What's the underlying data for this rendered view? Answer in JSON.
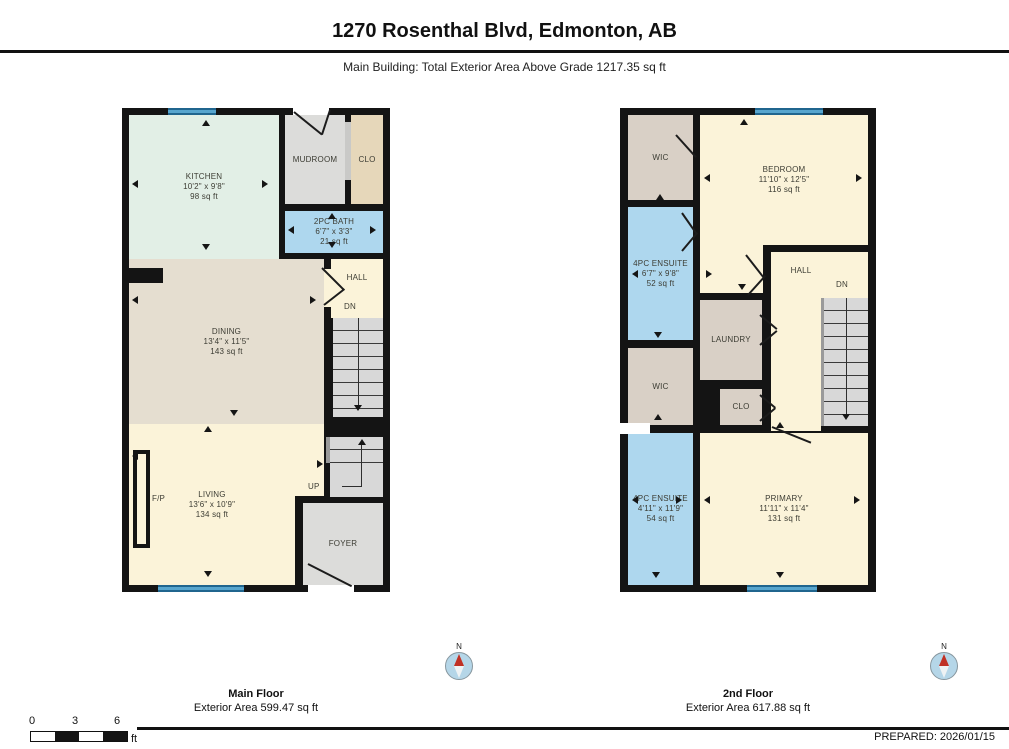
{
  "header": {
    "title": "1270 Rosenthal Blvd, Edmonton, AB",
    "subtitle": "Main Building: Total Exterior Area Above Grade 1217.35 sq ft"
  },
  "floors": {
    "main": {
      "title": "Main Floor",
      "area_label": "Exterior Area 599.47 sq ft",
      "rooms": {
        "kitchen": {
          "name": "KITCHEN",
          "dims": "10'2\" x 9'8\"",
          "area": "98 sq ft"
        },
        "mudroom": {
          "name": "MUDROOM"
        },
        "clo": {
          "name": "CLO"
        },
        "bath": {
          "name": "2PC BATH",
          "dims": "6'7\" x 3'3\"",
          "area": "21 sq ft"
        },
        "dining": {
          "name": "DINING",
          "dims": "13'4\" x 11'5\"",
          "area": "143 sq ft"
        },
        "hall": {
          "name": "HALL"
        },
        "living": {
          "name": "LIVING",
          "dims": "13'6\" x 10'9\"",
          "area": "134 sq ft"
        },
        "foyer": {
          "name": "FOYER"
        },
        "fireplace": {
          "name": "F/P"
        }
      },
      "stair_labels": {
        "down": "DN",
        "up": "UP"
      }
    },
    "second": {
      "title": "2nd Floor",
      "area_label": "Exterior Area 617.88 sq ft",
      "rooms": {
        "wic1": {
          "name": "WIC"
        },
        "bedroom": {
          "name": "BEDROOM",
          "dims": "11'10\" x 12'5\"",
          "area": "116 sq ft"
        },
        "ensuite1": {
          "name": "4PC ENSUITE",
          "dims": "6'7\" x 9'8\"",
          "area": "52 sq ft"
        },
        "hall": {
          "name": "HALL"
        },
        "laundry": {
          "name": "LAUNDRY"
        },
        "wic2": {
          "name": "WIC"
        },
        "clo": {
          "name": "CLO"
        },
        "ensuite2": {
          "name": "4PC ENSUITE",
          "dims": "4'11\" x 11'9\"",
          "area": "54 sq ft"
        },
        "primary": {
          "name": "PRIMARY",
          "dims": "11'11\" x 11'4\"",
          "area": "131 sq ft"
        }
      },
      "stair_labels": {
        "down": "DN"
      }
    }
  },
  "compass": {
    "north_label": "N"
  },
  "scale_bar": {
    "ticks": [
      "0",
      "3",
      "6"
    ],
    "unit": "ft"
  },
  "footer": {
    "prepared_label": "PREPARED: 2026/01/15"
  },
  "colors": {
    "wall": "#141414",
    "kitchen_mint": "#e2efe6",
    "dining_tan": "#e5ded0",
    "cream": "#fbf3d9",
    "bath_blue": "#aed7ee",
    "gray_room": "#dcdcda",
    "closet_tan": "#e6d7ba",
    "wic_tan": "#d9d0c6",
    "stairs_gray": "#d8d8d8",
    "window_blue": "#57a5ce"
  }
}
